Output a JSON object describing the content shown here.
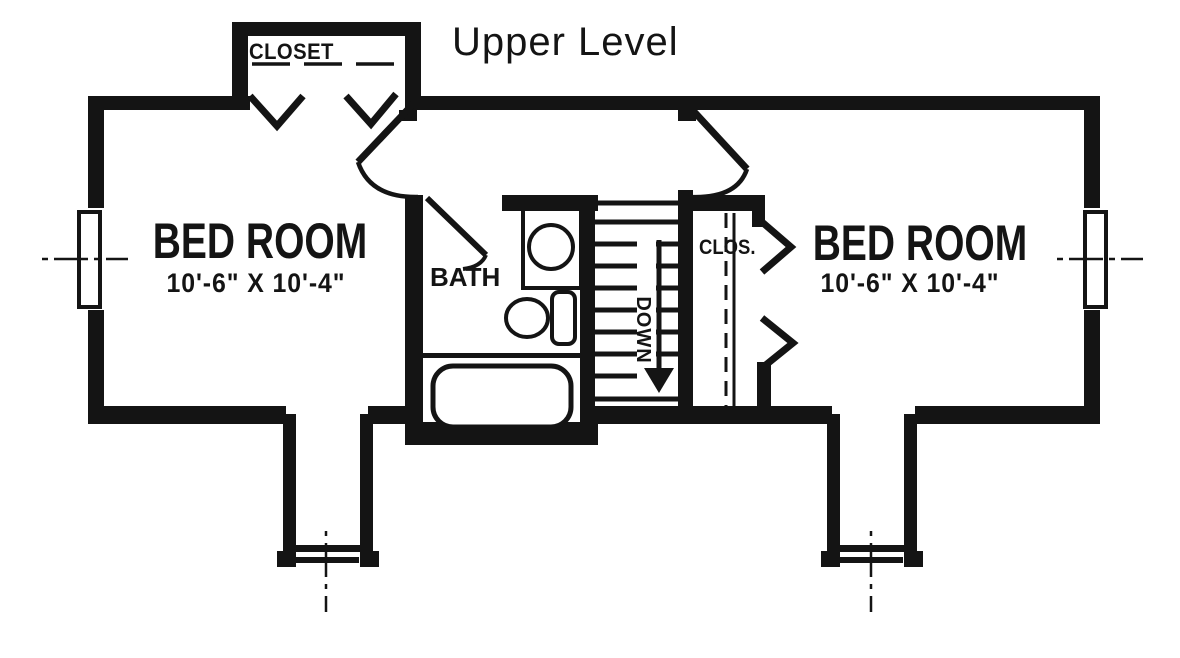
{
  "title": "Upper Level",
  "labels": {
    "closet_top": "CLOSET",
    "bedroom_left": {
      "name": "BED ROOM",
      "size": "10'-6\" X 10'-4\""
    },
    "bedroom_right": {
      "name": "BED ROOM",
      "size": "10'-6\" X 10'-4\""
    },
    "bath": "BATH",
    "closet_hall": "CLOS.",
    "stairs_direction": "DOWN"
  },
  "icons": {
    "stairs_arrow": "down-arrow",
    "fixtures": [
      "bathtub",
      "toilet",
      "sink"
    ],
    "symbols": [
      "window",
      "door-swing",
      "bifold-door-chevron",
      "center-line"
    ]
  },
  "colors": {
    "ink": "#141414",
    "paper": "#ffffff"
  }
}
